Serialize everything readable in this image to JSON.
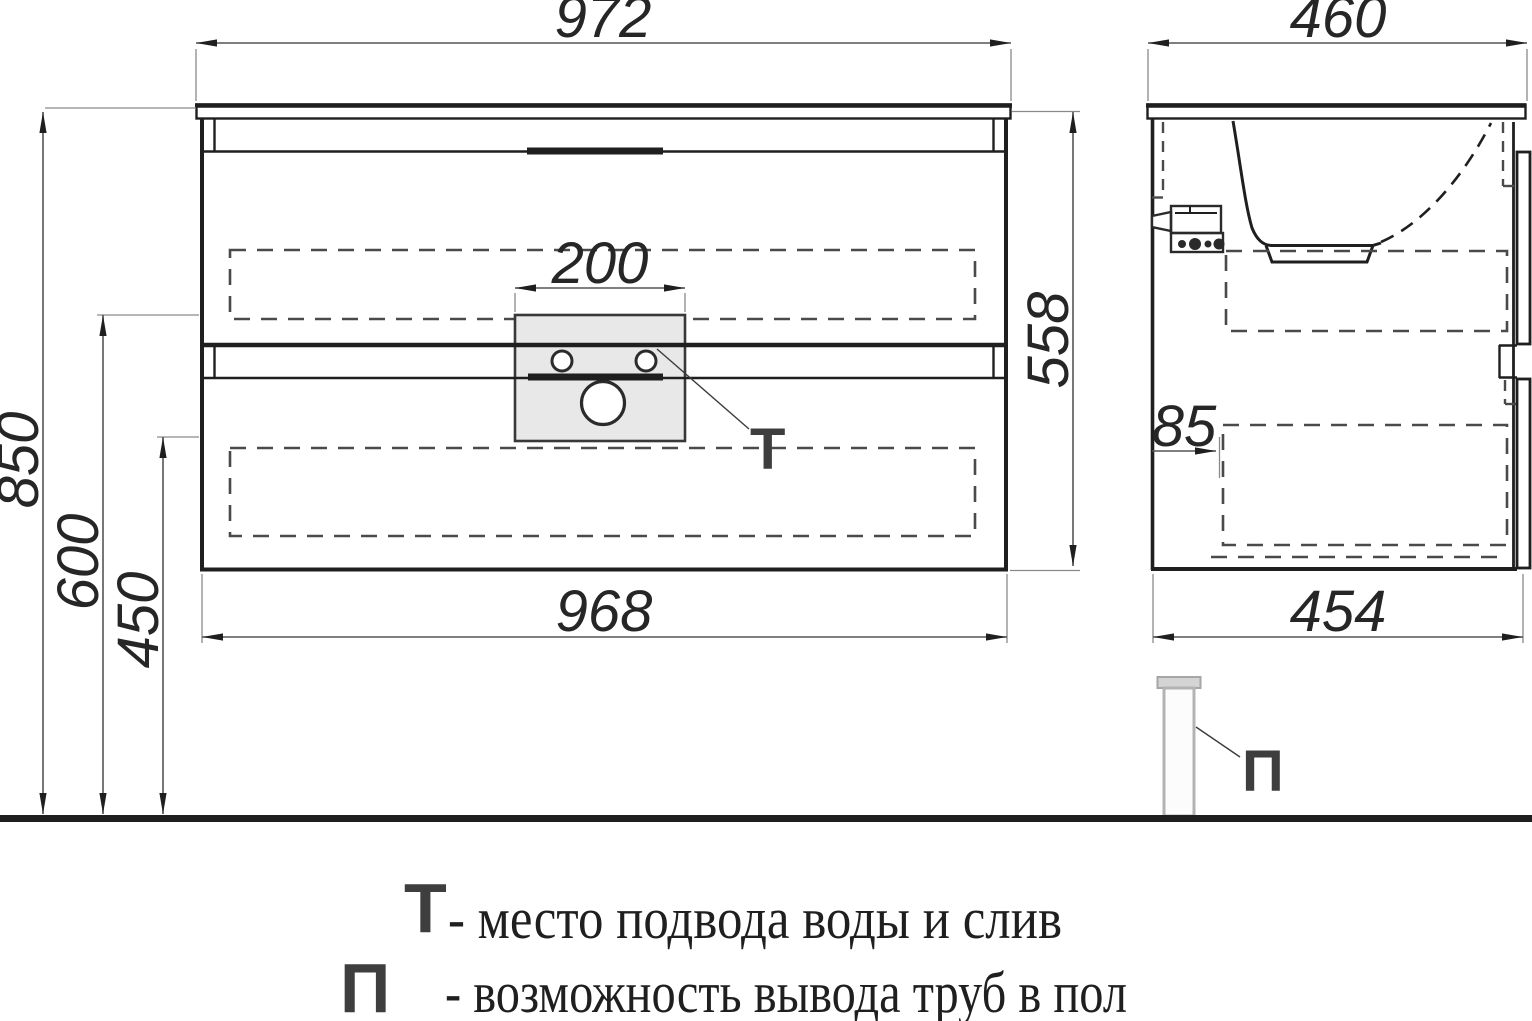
{
  "title": "vanity-cabinet-dimension-drawing",
  "dimensions": {
    "front_width_top": "972",
    "front_width_bottom": "968",
    "front_height_overall": "850",
    "front_height_mid": "600",
    "front_height_low": "450",
    "cabinet_box_height": "558",
    "cutout_width": "200",
    "side_depth_top": "460",
    "side_depth_bottom": "454",
    "side_back_offset": "85"
  },
  "markers": {
    "water_drain": "Т",
    "floor_pipe": "П"
  },
  "legend": {
    "line1_marker": "Т",
    "line1_text": "- место подвода воды и слив",
    "line2_marker": "П",
    "line2_text": "- возможность вывода труб в пол"
  },
  "colors": {
    "outline": "#1f1f1f",
    "hidden_dash": "#4a4a4a",
    "dimension_line": "#555555",
    "extension_line": "#8a8a8a",
    "panel_fill": "#e8e8e8",
    "marker_text": "#3e3e3e",
    "legend_text": "#1f1f1f",
    "pipe_outline": "#b3b3b3",
    "pipe_cap_fill": "#d4d4d4",
    "background": "#ffffff"
  }
}
